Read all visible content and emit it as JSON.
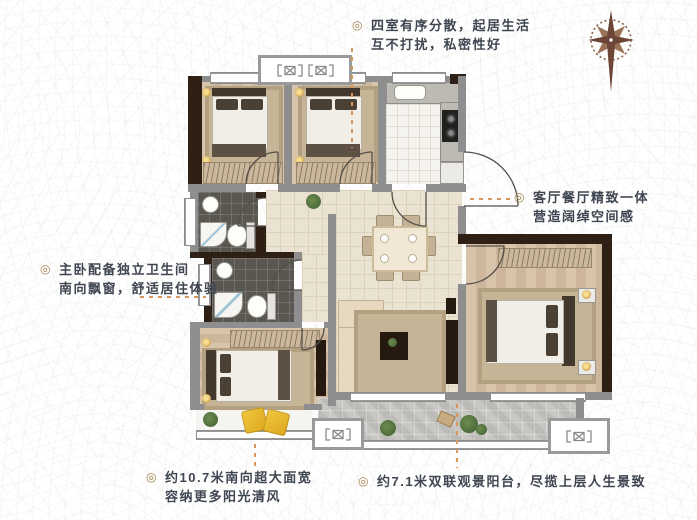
{
  "colors": {
    "annotation_text": "#3f4651",
    "bullet": "#a3814f",
    "dashed_line": "#d9975e",
    "compass": "#6d4637",
    "wall_gray": "#8e8e8e",
    "wall_dark": "#2e2014"
  },
  "annotations": {
    "top": {
      "bullet": "◎",
      "lines": [
        "四室有序分散，起居生活",
        "互不打扰，私密性好"
      ]
    },
    "right": {
      "bullet": "◎",
      "lines": [
        "客厅餐厅精致一体",
        "营造阔绰空间感"
      ]
    },
    "left": {
      "bullet": "◎",
      "lines": [
        "主卧配备独立卫生间",
        "南向飘窗，舒适居住体验"
      ]
    },
    "bottom_left": {
      "bullet": "◎",
      "lines": [
        "约10.7米南向超大面宽",
        "容纳更多阳光清风"
      ]
    },
    "bottom_right": {
      "bullet": "◎",
      "lines": [
        "约7.1米双联观景阳台，尽揽上层人生景致"
      ]
    }
  }
}
